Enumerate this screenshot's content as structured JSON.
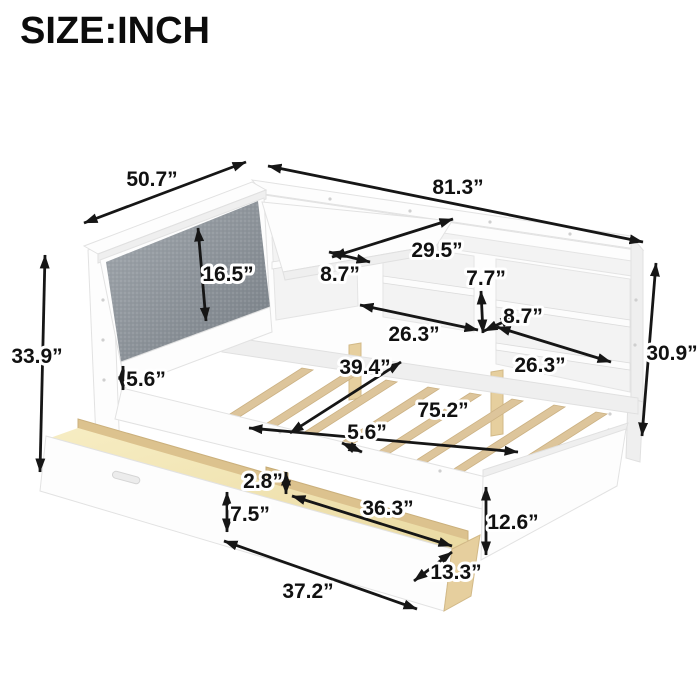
{
  "title": "SIZE:INCH",
  "unit": "INCH",
  "colors": {
    "arrow": "#161616",
    "cushion_gray": "#8a9197",
    "wood": "#e6cf9e",
    "frame_white": "#ffffff"
  },
  "dimensions": {
    "headboard_width": "50.7”",
    "overall_length": "81.3”",
    "ledge_length": "29.5”",
    "ledge_depth": "8.7”",
    "cushion_height": "16.5”",
    "middle_shelf_opening_height": "7.7”",
    "right_shelf_depth": "8.7”",
    "middle_shelf_width": "26.3”",
    "right_shelf_width": "26.3”",
    "headboard_total_height": "33.9”",
    "headboard_rail_height": "5.6”",
    "bed_width": "39.4”",
    "bed_inner_length": "75.2”",
    "slat_spacing": "5.6”",
    "bookcase_height": "30.9”",
    "drawer_divider_height": "2.8”",
    "drawer_inner_length": "36.3”",
    "drawer_front_height": "7.5”",
    "footboard_height": "12.6”",
    "drawer_depth": "13.3”",
    "drawer_outer_length": "37.2”"
  }
}
